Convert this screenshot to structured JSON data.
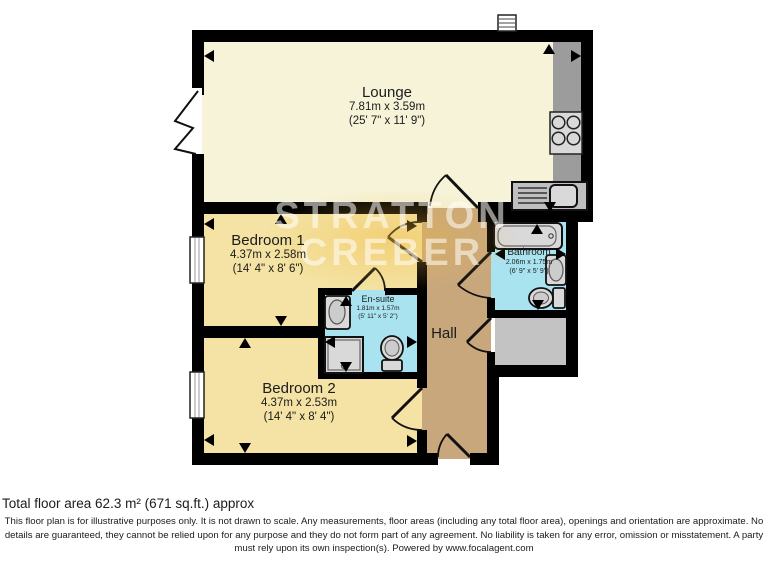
{
  "watermark": {
    "line1": "STRATTON",
    "line2": "CREBER"
  },
  "rooms": {
    "lounge": {
      "name": "Lounge",
      "metric": "7.81m x 3.59m",
      "imperial": "(25' 7\" x 11' 9\")"
    },
    "bedroom1": {
      "name": "Bedroom 1",
      "metric": "4.37m x 2.58m",
      "imperial": "(14' 4\" x 8' 6\")"
    },
    "bedroom2": {
      "name": "Bedroom 2",
      "metric": "4.37m x 2.53m",
      "imperial": "(14' 4\" x 8' 4\")"
    },
    "ensuite": {
      "name": "En-suite",
      "metric": "1.81m x 1.57m",
      "imperial": "(5' 11\" x 5' 2\")"
    },
    "bathroom": {
      "name": "Bathroom",
      "metric": "2.06m x 1.75m",
      "imperial": "(6' 9\" x 5' 9\")"
    },
    "hall": {
      "name": "Hall"
    }
  },
  "footer": {
    "total_area": "Total floor area 62.3 m² (671 sq.ft.) approx",
    "disclaimer": "This floor plan is for illustrative purposes only. It is not drawn to scale. Any measurements, floor areas (including any total floor area), openings and orientation are approximate. No details are guaranteed, they cannot be relied upon for any purpose and they do not form part of any agreement. No liability is taken for any error, omission or misstatement. A party must rely upon its own inspection(s). Powered by www.focalagent.com"
  },
  "colors": {
    "wall": "#000000",
    "lounge_fill": "#f7f3d9",
    "bedroom_fill": "#f4e3a4",
    "hall_fill": "#c8a77d",
    "wet_room_fill": "#aae3f0",
    "storage_fill": "#c3c3c3",
    "counter_fill": "#9c9c9c",
    "fixture_fill": "#d9d9d9",
    "watermark_text": "#ffffff",
    "watermark_glow": "#f0b93c"
  }
}
